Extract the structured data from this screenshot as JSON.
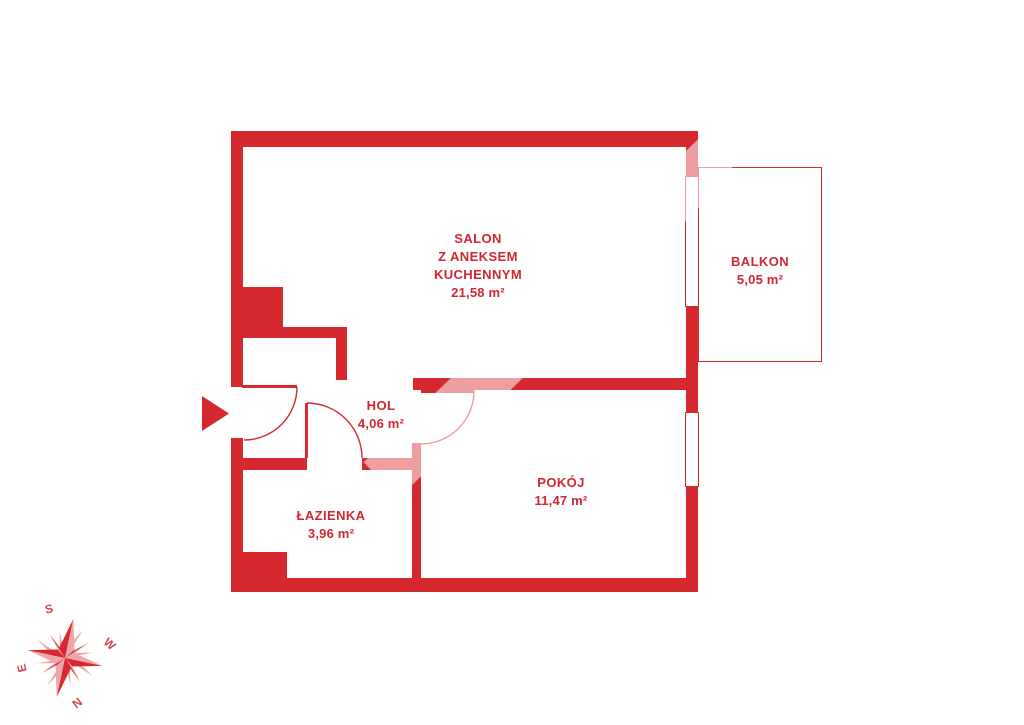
{
  "plan_title": "",
  "rooms": {
    "salon": {
      "line1": "SALON",
      "line2": "Z ANEKSEM",
      "line3": "KUCHENNYM",
      "area": "21,58 m²"
    },
    "balkon": {
      "name": "BALKON",
      "area": "5,05 m²"
    },
    "hol": {
      "name": "HOL",
      "area": "4,06 m²"
    },
    "pokoj": {
      "name": "POKÓJ",
      "area": "11,47 m²"
    },
    "lazienka": {
      "name": "ŁAZIENKA",
      "area": "3,96 m²"
    }
  },
  "compass": {
    "s": "S",
    "w": "W",
    "n": "N",
    "e": "E"
  },
  "colors": {
    "wall_red": "#d5292f",
    "label_red": "#cf2730",
    "compass_dark": "#d5292f",
    "compass_light": "#f0a6a9",
    "compass_letter": "#d0474d",
    "background": "#ffffff"
  }
}
